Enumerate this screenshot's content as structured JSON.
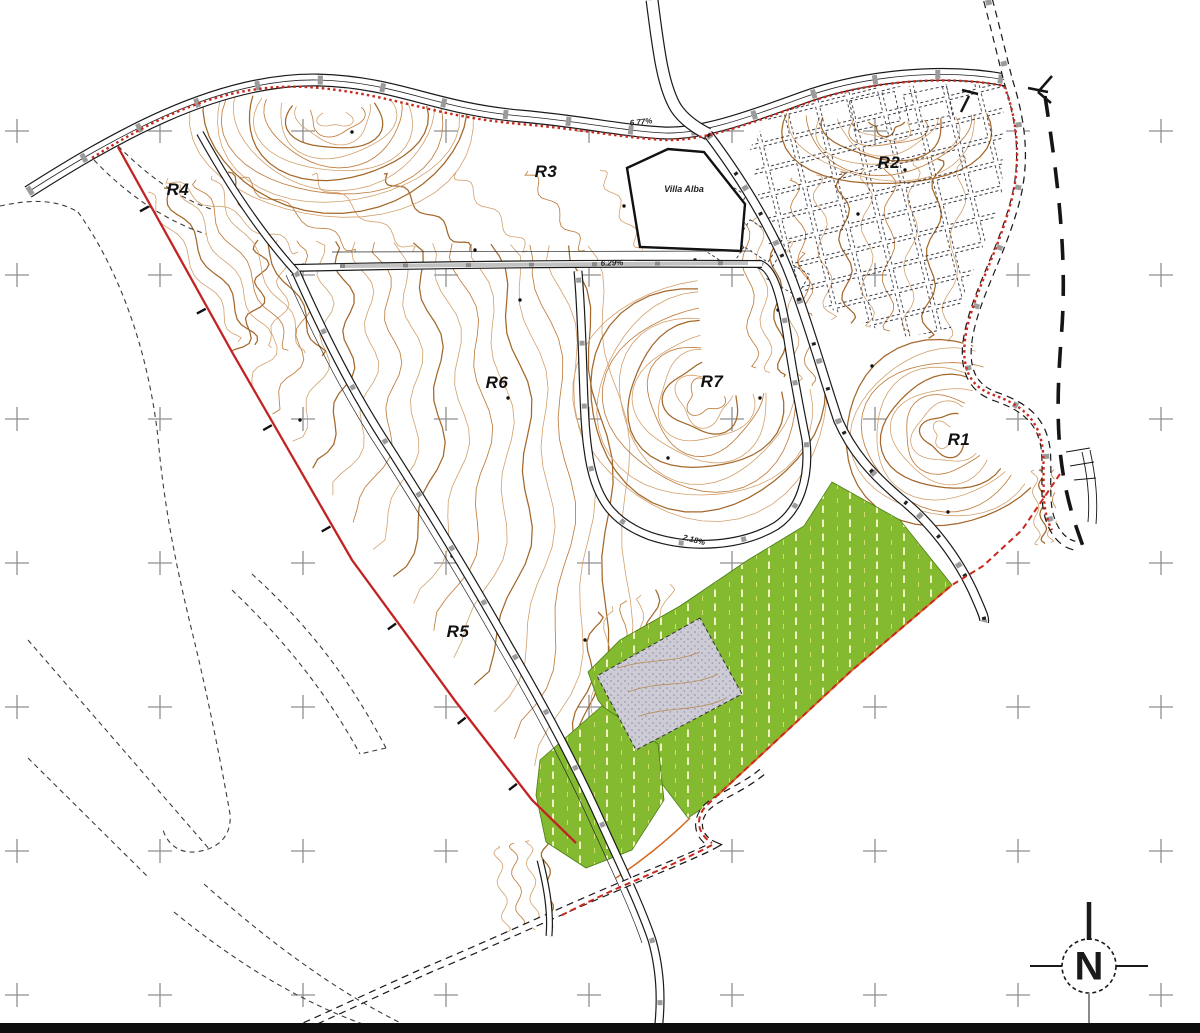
{
  "map": {
    "parcel_labels": [
      {
        "id": "R1",
        "label": "R1"
      },
      {
        "id": "R2",
        "label": "R2"
      },
      {
        "id": "R3",
        "label": "R3"
      },
      {
        "id": "R4",
        "label": "R4"
      },
      {
        "id": "R5",
        "label": "R5"
      },
      {
        "id": "R6",
        "label": "R6"
      },
      {
        "id": "R7",
        "label": "R7"
      }
    ],
    "site_labels": [
      {
        "id": "villa-alba",
        "label": "Villa Alba"
      }
    ],
    "slope_labels": [
      {
        "id": "slope-top-road",
        "label": "6.77%"
      },
      {
        "id": "slope-mid-road",
        "label": "6.29%"
      },
      {
        "id": "slope-loop-road",
        "label": "2.18%"
      }
    ],
    "compass": {
      "label": "N"
    },
    "colors": {
      "contour": "#bf7d3e",
      "contour_light": "#d2a06c",
      "contour_index": "#a4682b",
      "boundary_red": "#c8281e",
      "green_area": "#83ba30",
      "green_hatch": "#f0f0c0",
      "grey_hatch_area": "#cdccd6",
      "orange_boundary": "#d2691e",
      "road_line": "#1a1a1a",
      "grid_cross": "#8f8f8f"
    }
  }
}
